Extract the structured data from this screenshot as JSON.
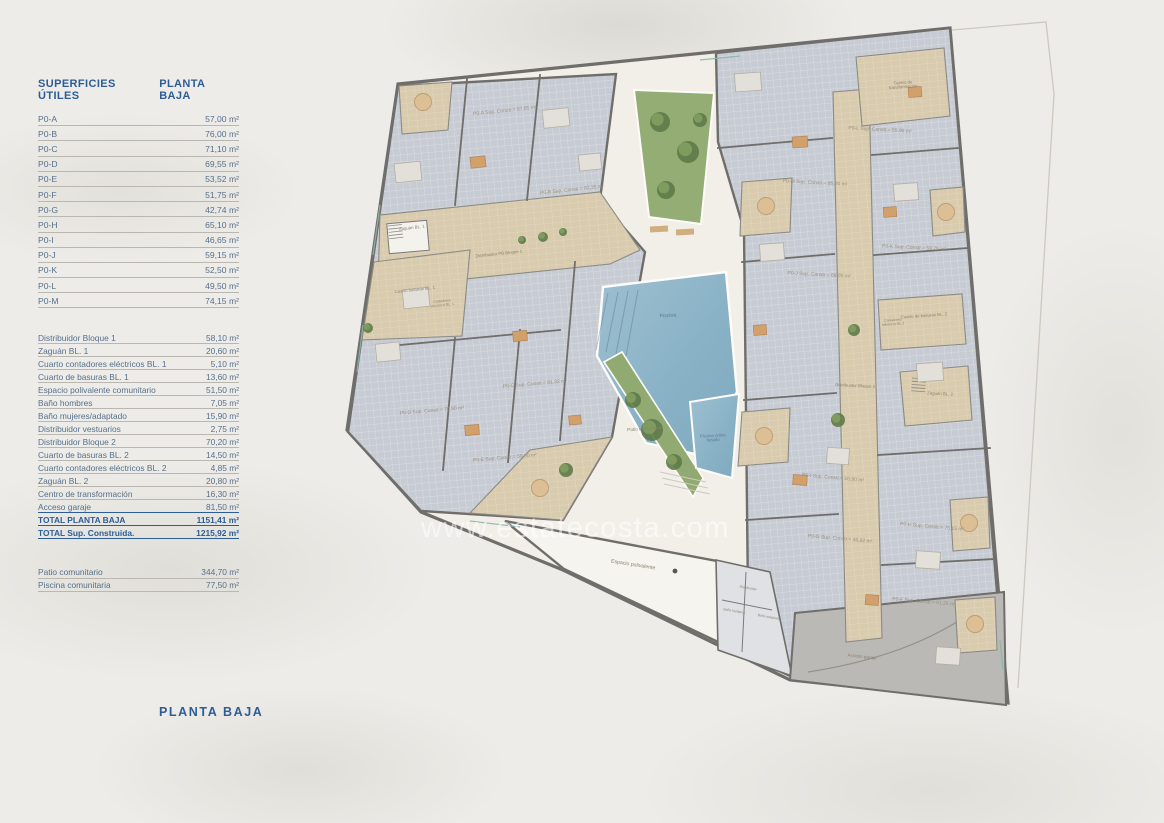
{
  "page": {
    "plan_title": "PLANTA BAJA",
    "watermark": "www.estatecosta.com"
  },
  "table": {
    "header": {
      "left": "SUPERFICIES ÚTILES",
      "right": "PLANTA BAJA"
    },
    "apartments": [
      {
        "label": "P0-A",
        "value": "57,00 m²"
      },
      {
        "label": "P0-B",
        "value": "76,00 m²"
      },
      {
        "label": "P0-C",
        "value": "71,10 m²"
      },
      {
        "label": "P0-D",
        "value": "69,55 m²"
      },
      {
        "label": "P0-E",
        "value": "53,52 m²"
      },
      {
        "label": "P0-F",
        "value": "51,75 m²"
      },
      {
        "label": "P0-G",
        "value": "42,74 m²"
      },
      {
        "label": "P0-H",
        "value": "65,10 m²"
      },
      {
        "label": "P0-I",
        "value": "46,65 m²"
      },
      {
        "label": "P0-J",
        "value": "59,15 m²"
      },
      {
        "label": "P0-K",
        "value": "52,50 m²"
      },
      {
        "label": "P0-L",
        "value": "49,50 m²"
      },
      {
        "label": "P0-M",
        "value": "74,15 m²"
      }
    ],
    "common": [
      {
        "label": "Distribuidor Bloque 1",
        "value": "58,10 m²"
      },
      {
        "label": "Zaguán BL. 1",
        "value": "20,60 m²"
      },
      {
        "label": "Cuarto contadores eléctricos BL. 1",
        "value": "5,10 m²"
      },
      {
        "label": "Cuarto de basuras BL. 1",
        "value": "13,60 m²"
      },
      {
        "label": "Espacio polivalente comunitario",
        "value": "51,50 m²"
      },
      {
        "label": "Baño hombres",
        "value": "7,05 m²"
      },
      {
        "label": "Baño mujeres/adaptado",
        "value": "15,90 m²"
      },
      {
        "label": "Distribuidor vestuarios",
        "value": "2,75 m²"
      },
      {
        "label": "Distribuidor Bloque 2",
        "value": "70,20 m²"
      },
      {
        "label": "Cuarto de basuras BL. 2",
        "value": "14,50 m²"
      },
      {
        "label": "Cuarto contadores eléctricos BL. 2",
        "value": "4,85 m²"
      },
      {
        "label": "Zaguán BL. 2",
        "value": "20,80 m²"
      },
      {
        "label": "Centro de transformación",
        "value": "16,30 m²"
      },
      {
        "label": "Acceso garaje",
        "value": "81,50 m²"
      }
    ],
    "totals": [
      {
        "label": "TOTAL PLANTA BAJA",
        "value": "1151,41 m²"
      },
      {
        "label": "TOTAL Sup. Construida.",
        "value": "1215,92 m²"
      }
    ],
    "outdoor": [
      {
        "label": "Patio comunitario",
        "value": "344,70 m²"
      },
      {
        "label": "Piscina comunitaria",
        "value": "77,50 m²"
      }
    ]
  },
  "plan": {
    "labels": {
      "p0a": "P0-A Sup. Constr.= 67,65 m²",
      "p0b": "P0-B Sup. Constr.= 82,35 m²",
      "p0c": "P0-C Sup. Constr.= 81,32 m²",
      "p0d": "P0-D Sup. Constr.= 70,90 m²",
      "p0e": "P0-E Sup. Constr.= 59,80 m²",
      "p0f": "P0-F Sup. Constr.= 61,25 m²",
      "p0g": "P0-G Sup. Constr.= 49,82 m²",
      "p0h": "P0-H Sup. Constr.= 75,15 m²",
      "p0i": "P0-I Sup. Constr.= 55,90 m²",
      "p0j": "P0-J Sup. Constr.= 68,00 m²",
      "p0k": "P0-K Sup. Constr.= 59,75 m²",
      "p0l": "P0-L Sup. Constr.= 55,95 m²",
      "p0m": "P0-M Sup. Constr.= 85,20 m²",
      "zaguan1": "Zaguán BL. 1",
      "distribuidor1": "Distribuidor PB Bloque 1",
      "basuras1": "Cuarto basuras BL. 1",
      "contadores1": "Contadores\neléctricos BL. 1",
      "centro": "Centro de\ntransformación",
      "basuras2": "Cuarto de basuras BL. 2",
      "contadores2": "Contadores\neléctricos BL.2",
      "distribuidor2": "Distribuidor Bloque 2",
      "zaguan2": "Zaguán BL. 2",
      "piscina": "Piscina",
      "piscina2": "Piscina sobre\nforjado",
      "patio": "Patio comunitario",
      "espacio": "Espacio polivalente",
      "distribuidor3": "Distribuidor",
      "banoh": "Baño hombres",
      "banoa": "Baño adaptado",
      "acceso": "Acceso garaje"
    },
    "colors": {
      "accent_blue": "#2c5d96",
      "row_text": "#56708b",
      "wall_gray": "#6f6e6b",
      "apartment_tile": "#c7cbd3",
      "common_stone": "#d9cbae",
      "pool_blue": "#8fb7c9",
      "garden_green": "#93ad74",
      "courtyard": "#f2efe9",
      "ramp_gray": "#bab9b5"
    }
  }
}
